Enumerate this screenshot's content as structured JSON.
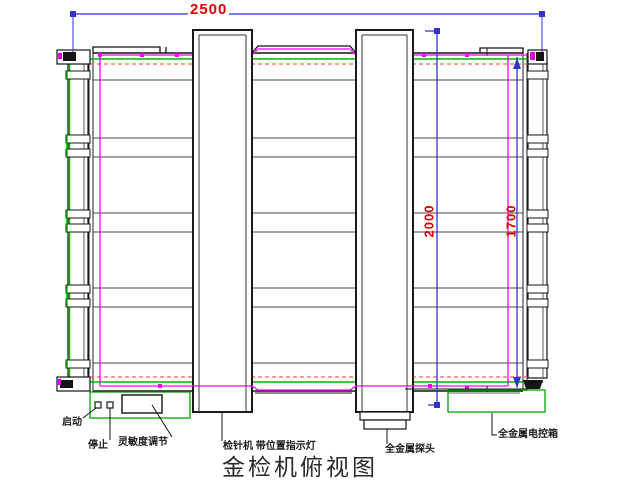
{
  "title": "金检机俯视图",
  "dimensions": {
    "overall_length": "2500",
    "probe_bridge_length": "2000",
    "frame_width": "1700"
  },
  "labels": {
    "start": "启动",
    "stop": "停止",
    "sensitivity": "灵敏度调节",
    "needle_detector": "检针机 带位置指示灯",
    "metal_probe": "全金属探头",
    "control_box": "全金属电控箱"
  },
  "colors": {
    "dimension_line": "#3232d0",
    "dimension_text": "#e00000",
    "belt_outline": "#ff00ff",
    "frame_green": "#00b800",
    "alarm_red_dashed": "#ff5a5a",
    "beam_gray": "#6e6e6e",
    "machine_black": "#151515"
  }
}
